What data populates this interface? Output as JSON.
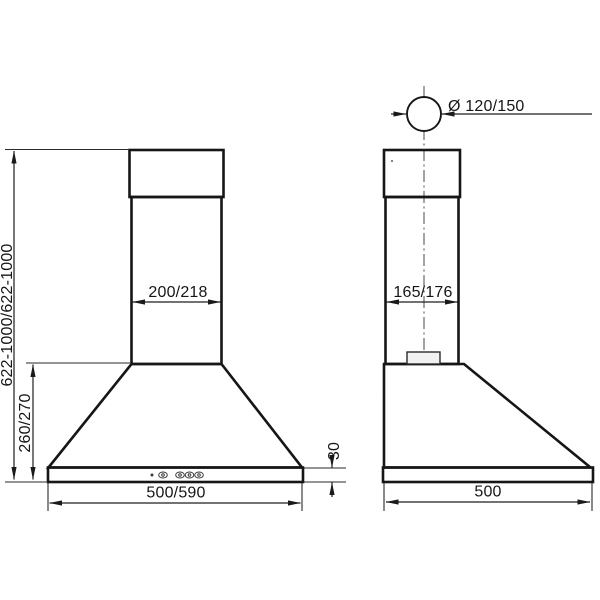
{
  "drawing": {
    "type": "technical-dimension-drawing",
    "subject": "kitchen cooker hood — front and side elevations with dimensions (mm)",
    "views": {
      "front": "front elevation",
      "side": "side elevation"
    },
    "dimensions": {
      "duct_diameter": "Ø 120/150",
      "overall_height": "622-1000/622-1000",
      "body_height": "260/270",
      "chimney_width_front": "200/218",
      "chimney_depth_side": "165/176",
      "base_panel_height": "30",
      "overall_width_front": "500/590",
      "overall_depth_side": "500"
    },
    "colors": {
      "line": "#161616",
      "dimension_line": "#1d1d1d",
      "fill_light": "#f0f0f0",
      "background": "#ffffff"
    }
  }
}
